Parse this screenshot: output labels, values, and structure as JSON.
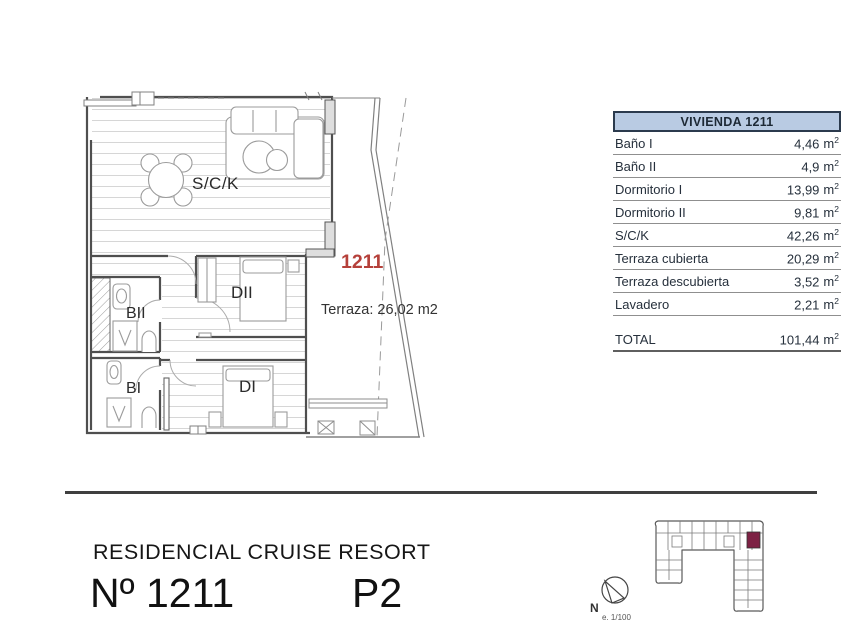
{
  "plan": {
    "unit_number_label": "1211",
    "terrace_area_label": "Terraza: 26,02 m2",
    "room_labels": {
      "salon_kitchen": "S/C/K",
      "dormitorio2": "DII",
      "bano2": "BII",
      "bano1": "BI",
      "dormitorio1": "DI"
    }
  },
  "area_table": {
    "title": "VIVIENDA 1211",
    "unit": "m",
    "exponent": "2",
    "rows": [
      {
        "label": "Baño I",
        "value": "4,46"
      },
      {
        "label": "Baño II",
        "value": "4,9"
      },
      {
        "label": "Dormitorio I",
        "value": "13,99"
      },
      {
        "label": "Dormitorio II",
        "value": "9,81"
      },
      {
        "label": "S/C/K",
        "value": "42,26"
      },
      {
        "label": "Terraza cubierta",
        "value": "20,29"
      },
      {
        "label": "Terraza descubierta",
        "value": "3,52"
      },
      {
        "label": "Lavadero",
        "value": "2,21"
      }
    ],
    "total": {
      "label": "TOTAL",
      "value": "101,44"
    }
  },
  "footer": {
    "project_name": "RESIDENCIAL CRUISE RESORT",
    "unit_number": "Nº 1211",
    "floor": "P2"
  },
  "compass": {
    "north": "N",
    "scale": "e. 1/100"
  },
  "colors": {
    "accent_red": "#b5403a",
    "table_header_bg": "#b9cbe3",
    "table_header_border": "#2b3a4d",
    "highlight_unit": "#7d2144"
  }
}
